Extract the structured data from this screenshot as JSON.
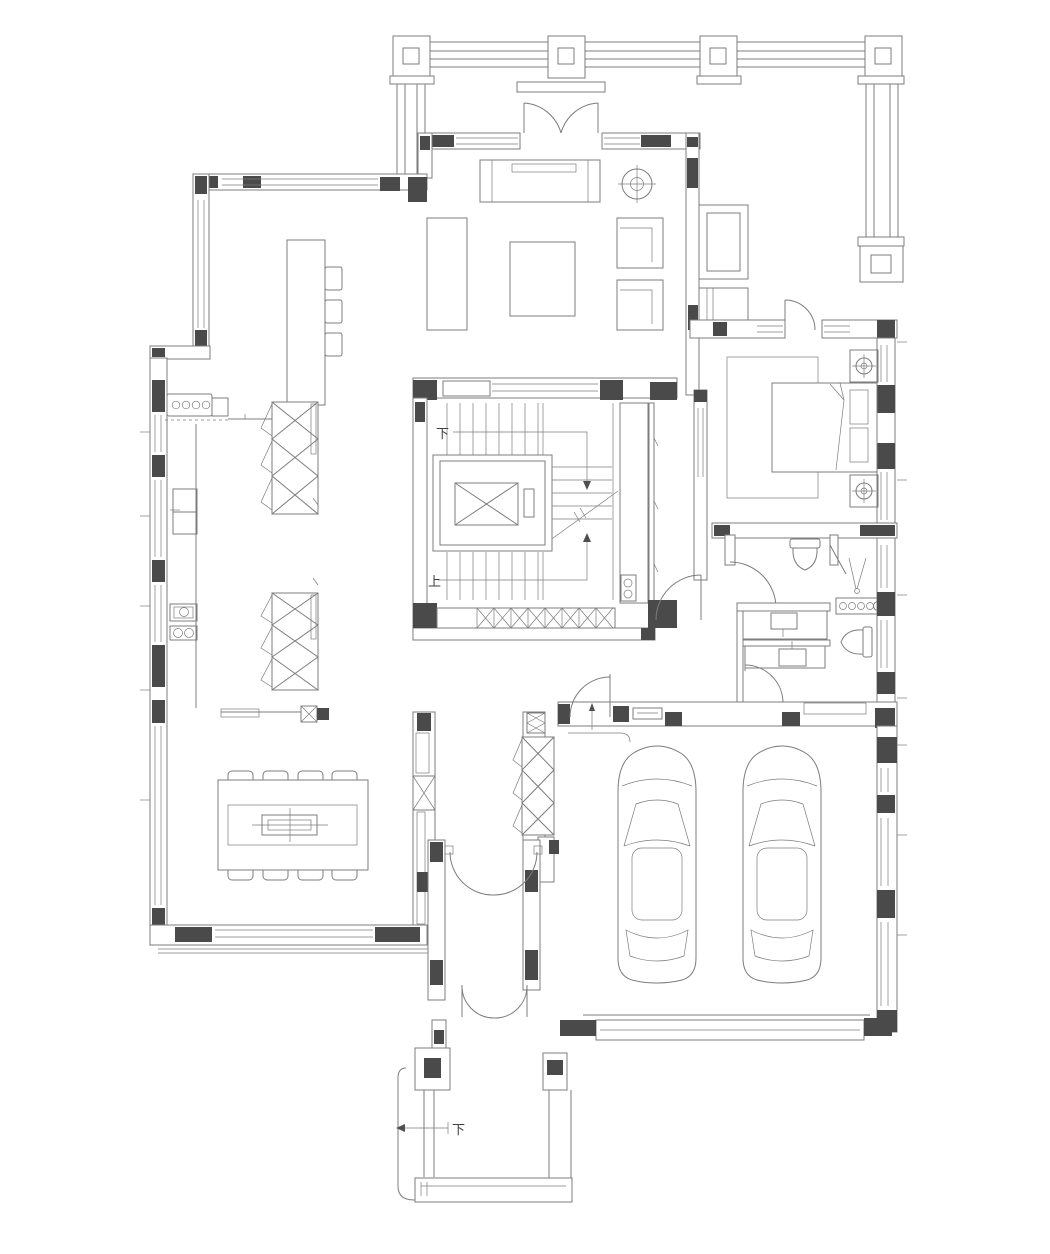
{
  "labels": {
    "stair_down": "下",
    "stair_up": "上",
    "entry_step_down": "下"
  },
  "colors": {
    "background": "#ffffff",
    "line": "#7c7c7c",
    "line_dark": "#4f4f4f",
    "fill_dark": "#4a4a4a",
    "text": "#3f3f3f"
  },
  "symbols": {
    "furniture_icons": [
      "pergola-column-icon",
      "french-door-icon",
      "sofa-icon",
      "console-table-icon",
      "coffee-table-icon",
      "armchair-icon",
      "ceiling-light-icon",
      "tv-cabinet-icon",
      "bar-counter-icon",
      "bar-stool-icon",
      "kitchen-sink-icon",
      "refrigerator-icon",
      "cooktop-icon",
      "display-cabinet-icon",
      "elevator-icon",
      "staircase-icon",
      "screen-cabinet-icon",
      "storage-cabinet-icon",
      "bed-icon",
      "rug-icon",
      "nightstand-lamp-icon",
      "toilet-icon",
      "vanity-sink-icon",
      "shower-icon",
      "washer-panel-icon",
      "dining-table-icon",
      "dining-chair-icon",
      "shoe-cabinet-icon",
      "entry-double-door-icon",
      "car-icon",
      "garage-door-icon",
      "porch-column-icon"
    ]
  }
}
